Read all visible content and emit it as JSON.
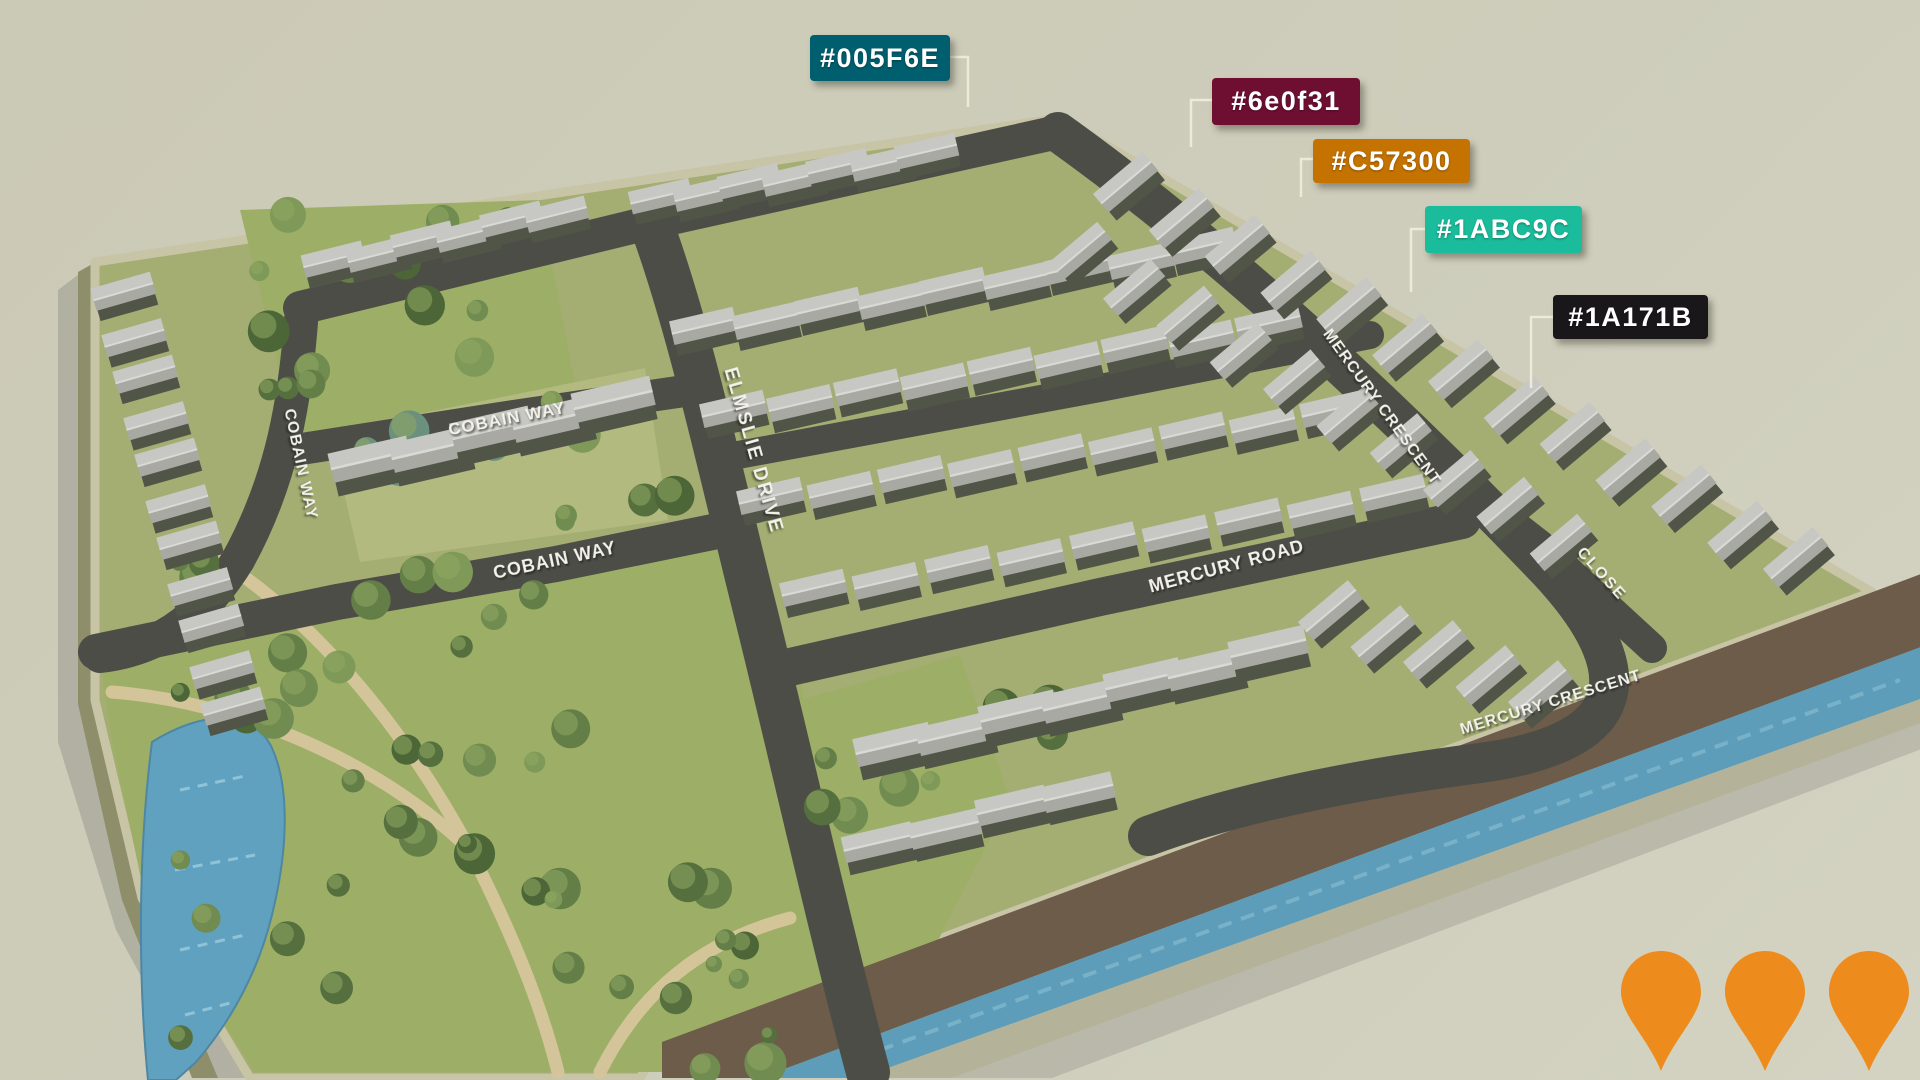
{
  "color_labels": [
    {
      "text": "#005F6E",
      "color": "#005F6E"
    },
    {
      "text": "#6e0f31",
      "color": "#6E0F31"
    },
    {
      "text": "#C57300",
      "color": "#C57300"
    },
    {
      "text": "#1ABC9C",
      "color": "#1ABC9C"
    },
    {
      "text": "#1A171B",
      "color": "#1A171B"
    }
  ],
  "streets": [
    {
      "name": "COBAIN WAY"
    },
    {
      "name": "COBAIN WAY"
    },
    {
      "name": "COBAIN WAY"
    },
    {
      "name": "ELMSLIE DRIVE"
    },
    {
      "name": "MERCURY ROAD"
    },
    {
      "name": "MERCURY CRESCENT"
    },
    {
      "name": "MERCURY CRESCENT"
    },
    {
      "name": "CLOSE"
    }
  ],
  "pins": {
    "count": 3,
    "color": "#ED8C1D"
  }
}
